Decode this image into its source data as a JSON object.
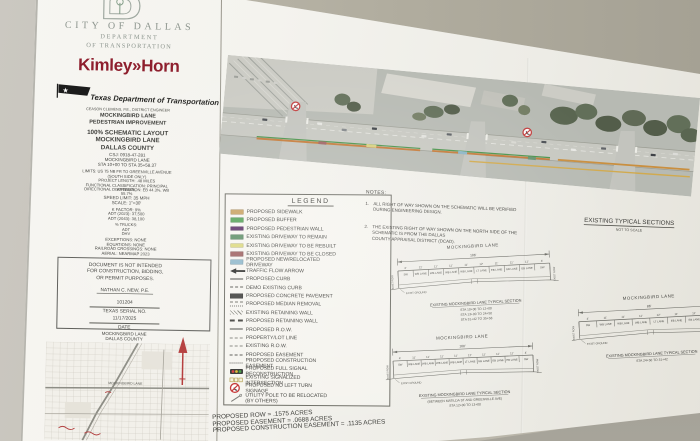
{
  "colors": {
    "kimley_red": "#8e1e2d",
    "annotation_red": "#b23535",
    "paper": "#f3f2ed",
    "wall": "#c1beb4"
  },
  "title_block": {
    "city_lines": [
      "CITY OF DALLAS",
      "DEPARTMENT",
      "OF TRANSPORTATION"
    ],
    "kimley_horn": "Kimley»Horn",
    "txdot_name": "Texas Department of Transportation",
    "txdot_sub": "CEASON CLEMENS, P.E., DISTRICT ENGINEER",
    "project_lines": [
      "MOCKINGBIRD LANE",
      "PEDESTRIAN IMPROVEMENT"
    ],
    "layout_lines": [
      "100% SCHEMATIC LAYOUT",
      "MOCKINGBIRD LANE",
      "DALLAS COUNTY"
    ],
    "control_lines": [
      "CSJ: 0918-47-281",
      "MOCKINGBIRD LANE",
      "STA 10+00 TO STA 35+58.37"
    ],
    "limit_lines": [
      "LIMITS: US 75 NB FR TO GREENVILLE AVENUE",
      "(SOUTH SIDE ONLY)",
      "PROJECT LENGTH: .48 MILES",
      "FUNCTIONAL CLASSIFICATION: PRINCIPAL ARTERIAL",
      "DIRECTIONAL DISTRIBUTION: EB 44.3%, WB 55.7%"
    ],
    "speed_lines": [
      "SPEED LIMIT: 35 MPH",
      "SCALE: 1\"=30'"
    ],
    "traffic_lines": [
      "K FACTOR: 9%",
      "ADT (2023): 37,500",
      "ADT (2043): 38,100"
    ],
    "trucks_lines": [
      "% TRUCKS:",
      "ADT",
      "DHV"
    ],
    "misc_lines": [
      "EXCEPTIONS: NONE",
      "EQUATIONS: NONE",
      "RAILROAD CROSSINGS: NONE",
      "AERIAL: NEARMAP 2023"
    ],
    "disclaimer_lines": [
      "DOCUMENT IS NOT INTENDED",
      "FOR CONSTRUCTION, BIDDING,",
      "OR PERMIT PURPOSES."
    ],
    "signature": {
      "name": "NATHAN C. NEW,  P.E.",
      "serial": "101204",
      "serial_label": "TEXAS SERIAL NO.",
      "date": "11/17/2025",
      "date_label": "DATE"
    },
    "map_heading": [
      "MOCKINGBIRD LANE",
      "DALLAS COUNTY"
    ],
    "map_road_label": "MOCKINGBIRD LANE"
  },
  "legend": {
    "title": "LEGEND",
    "items": [
      {
        "key": "sidewalk-swatch",
        "type": "swatch",
        "color": "#c9a262",
        "label": "PROPOSED SIDEWALK"
      },
      {
        "key": "buffer-swatch",
        "type": "swatch",
        "color": "#55a258",
        "label": "PROPOSED BUFFER"
      },
      {
        "key": "pedestrian-wall-swatch",
        "type": "swatch",
        "color": "#5d3069",
        "label": "PROPOSED PEDESTRIAN WALL"
      },
      {
        "key": "driveway-remain-swatch",
        "type": "swatch",
        "color": "#5f8f68",
        "label": "EXISTING DRIVEWAY TO REMAIN"
      },
      {
        "key": "driveway-rebuilt-swatch",
        "type": "swatch",
        "color": "#dcd87f",
        "label": "EXISTING DRIVEWAY TO BE REBUILT"
      },
      {
        "key": "driveway-closed-swatch",
        "type": "swatch",
        "color": "#9e6060",
        "label": "EXISTING DRIVEWAY TO BE CLOSED"
      },
      {
        "key": "driveway-new-swatch",
        "type": "swatch",
        "color": "#8fb7ca",
        "label": "PROPOSED NEW/RELOCATED DRIVEWAY"
      },
      {
        "key": "traffic-flow-arrow-icon",
        "type": "arrow",
        "label": "TRAFFIC FLOW ARROW"
      },
      {
        "key": "proposed-curb-line",
        "type": "line-solid",
        "label": "PROPOSED CURB"
      },
      {
        "key": "demo-curb-line",
        "type": "line-dashed",
        "label": "DEMO EXISTING CURB"
      },
      {
        "key": "concrete-pavement-swatch",
        "type": "swatch",
        "color": "#3f3f3d",
        "label": "PROPOSED CONCRETE PAVEMENT"
      },
      {
        "key": "median-removal-swatch",
        "type": "squiggle",
        "label": "PROPOSED MEDIAN REMOVAL"
      },
      {
        "key": "existing-retaining-wall-line",
        "type": "hatch",
        "label": "EXISTING RETAINING WALL"
      },
      {
        "key": "proposed-retaining-wall-line",
        "type": "line-thickdash",
        "label": "PROPOSED RETAINING WALL"
      },
      {
        "key": "proposed-row-line",
        "type": "line-solid",
        "label": "PROPOSED R.O.W."
      },
      {
        "key": "property-lot-line",
        "type": "line-dashdot",
        "label": "PROPERTY/LOT LINE"
      },
      {
        "key": "existing-row-line",
        "type": "line-dashdot",
        "label": "EXISTING R.O.W."
      },
      {
        "key": "proposed-easement-line",
        "type": "line-dashed",
        "label": "PROPOSED EASEMENT"
      },
      {
        "key": "construction-easement-line",
        "type": "line-dotted",
        "label": "PROPOSED CONSTRUCTION EASEMENT"
      },
      {
        "key": "signal-reconstruction-icon",
        "type": "signal-filled",
        "label": "PROPOSED FULL SIGNAL RECONSTRUCTION"
      },
      {
        "key": "signalized-intersection-icon",
        "type": "signal-open",
        "label": "EXISTING SIGNALIZED INTERSECTION"
      },
      {
        "key": "no-left-turn-icon",
        "type": "no-left-turn",
        "label": "PROPOSED NO LEFT TURN SIGNAGE"
      },
      {
        "key": "utility-pole-icon",
        "type": "pole",
        "label": "UTILITY POLE TO BE RELOCATED\n(BY OTHERS)"
      }
    ]
  },
  "notes": {
    "title": "NOTES:",
    "n1_num": "1.",
    "n1_text": "ALL RIGHT OF WAY SHOWN ON THE SCHEMATIC WILL BE VERIFIED DURING ENGINEERING DESIGN.",
    "n2_num": "2.",
    "n2_text": "THE EXISTING RIGHT OF WAY SHOWN ON THE NORTH SIDE OF THE SCHEMATIC IS FROM THE DALLAS\nCOUNTY APPRAISAL DISTRICT (DCAD)."
  },
  "sections_heading": {
    "title": "EXISTING TYPICAL SECTIONS",
    "subtitle": "NOT TO SCALE"
  },
  "sections": [
    {
      "heading": "MOCKINGBIRD LANE",
      "dim": "106'",
      "widths": [
        "4'",
        "11'",
        "11'",
        "11'",
        "11'",
        "12'",
        "11'",
        "11'",
        "11'",
        "4'"
      ],
      "lanes": [
        "SW",
        "WB LANE",
        "WB LANE",
        "WB LANE",
        "WB LANE",
        "LT LANE",
        "EB LANE",
        "EB LANE",
        "EB LANE",
        "SW"
      ],
      "ground": "EXIST GROUND",
      "end_label": "EXIST ROW",
      "caption": [
        "EXISTING MOCKINGBIRD LANE TYPICAL SECTION",
        "STA 10+00 TO 12+00",
        "STA 13+00 TO 24+50",
        "STA 31+42 TO 35+58"
      ]
    },
    {
      "heading": "MOCKINGBIRD LANE",
      "dim": "100'",
      "widths": [
        "4'",
        "11'",
        "11'",
        "11'",
        "11'",
        "12'",
        "11'",
        "11'",
        "11'",
        "4'"
      ],
      "lanes": [
        "SW",
        "WB LANE",
        "WB LANE",
        "WB LANE",
        "WB LANE",
        "LT LANE",
        "EB LANE",
        "EB LANE",
        "EB LANE",
        "SW"
      ],
      "ground": "EXIST GROUND",
      "end_label": "EXIST ROW",
      "caption": [
        "EXISTING MOCKINGBIRD LANE TYPICAL SECTION",
        "(BETWEEN MATILDA ST AND GREENVILLE AVE)",
        "STA 12+00 TO 13+00"
      ]
    },
    {
      "heading": "MOCKINGBIRD LANE",
      "dim": "86'",
      "widths": [
        "4'",
        "11'",
        "11'",
        "11'",
        "12'",
        "11'",
        "11'",
        "4'"
      ],
      "lanes": [
        "SW",
        "WB LANE",
        "WB LANE",
        "WB LANE",
        "LT LANE",
        "EB LANE",
        "EB LANE",
        "SW"
      ],
      "ground": "EXIST GROUND",
      "end_label": "EXIST ROW",
      "caption": [
        "EXISTING MOCKINGBIRD LANE TYPICAL SECTION",
        "STA 24+50 TO 31+42"
      ]
    }
  ],
  "acreage": {
    "lines": [
      "PROPOSED ROW = .1575 ACRES",
      "PROPOSED EASEMENT = .0688 ACRES",
      "PROPOSED CONSTRUCTION EASEMENT = .1135 ACRES"
    ]
  }
}
